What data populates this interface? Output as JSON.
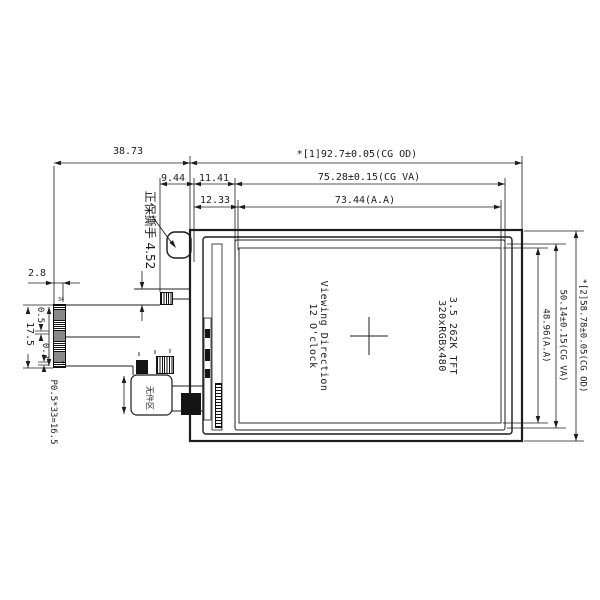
{
  "dimensions": {
    "top": {
      "offset_left": "38.73",
      "cg_od_width": "*[1]92.7±0.05(CG OD)",
      "d_9_44": "9.44",
      "d_11_41": "11.41",
      "cg_va_width": "75.28±0.15(CG VA)",
      "d_12_33": "12.33",
      "aa_width": "73.44(A.A)"
    },
    "right": {
      "cg_od_height": "*[2]58.78±0.05(CG OD)",
      "cg_va_height": "50.14±0.15(CG VA)",
      "aa_height": "48.96(A.A)"
    },
    "left": {
      "fpc_contact_width": "2.8",
      "connector_height": "17.5",
      "d_0_5": "0.5",
      "d_0_3": "0.3",
      "pin_pitch": "P0.5*33=16.5"
    }
  },
  "panel": {
    "spec_line1": "3.5 262K TFT",
    "spec_line2": "320xRGBx480",
    "view_line1": "Viewing Direction",
    "view_line2": "12 O'clock"
  },
  "annotations": {
    "tear_tab": "正保撕手 4.52",
    "keepout_area": "无件区",
    "pin_last": "34",
    "pin_first": "1"
  },
  "colors": {
    "line": "#1c1c1c",
    "background": "#ffffff"
  }
}
